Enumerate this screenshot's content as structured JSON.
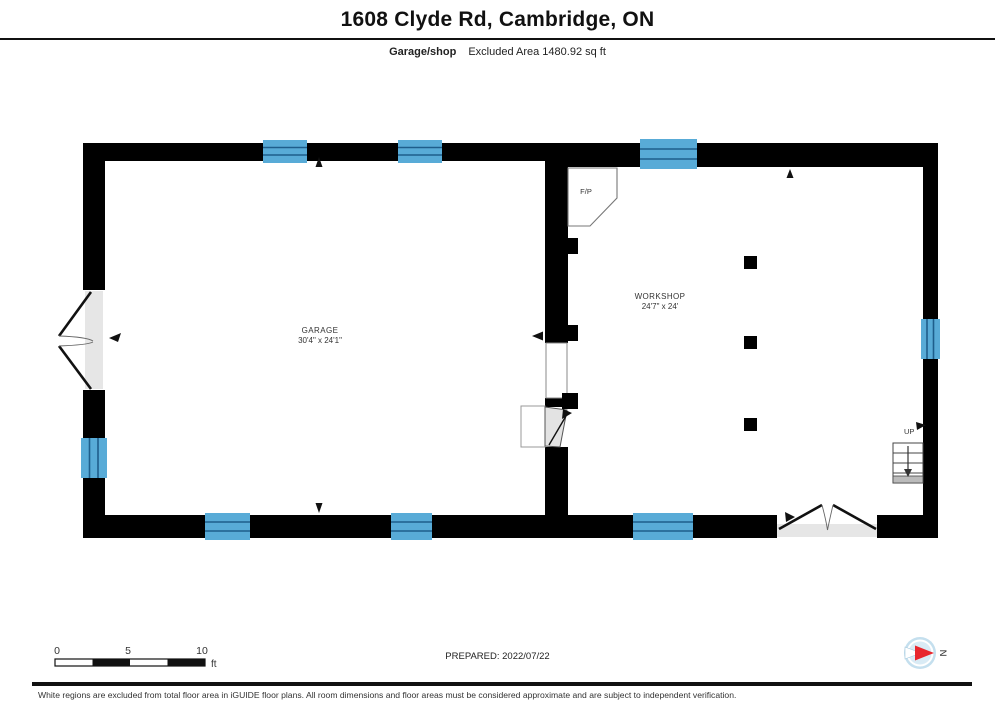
{
  "header": {
    "title": "1608 Clyde Rd, Cambridge, ON",
    "floor_label": "Garage/shop",
    "area_label": "Excluded Area 1480.92 sq ft"
  },
  "rooms": {
    "garage": {
      "name": "GARAGE",
      "dims": "30'4\" x 24'1\""
    },
    "workshop": {
      "name": "WORKSHOP",
      "dims": "24'7\" x 24'"
    }
  },
  "labels": {
    "fireplace": "F/P",
    "up": "UP",
    "north": "N"
  },
  "scale_bar": {
    "tick0": "0",
    "tick5": "5",
    "tick10": "10",
    "unit": "ft"
  },
  "footer": {
    "prepared": "PREPARED: 2022/07/22",
    "disclaimer": "White regions are excluded from total floor area in iGUIDE floor plans. All room dimensions and floor areas must be considered approximate and are subject to independent verification."
  },
  "colors": {
    "wall": "#000000",
    "window_blue": "#58abd7",
    "window_line": "#1e5e8c",
    "door_gray": "#e6e6e6",
    "compass_red": "#e8262d",
    "compass_blue": "#c4dfee"
  }
}
